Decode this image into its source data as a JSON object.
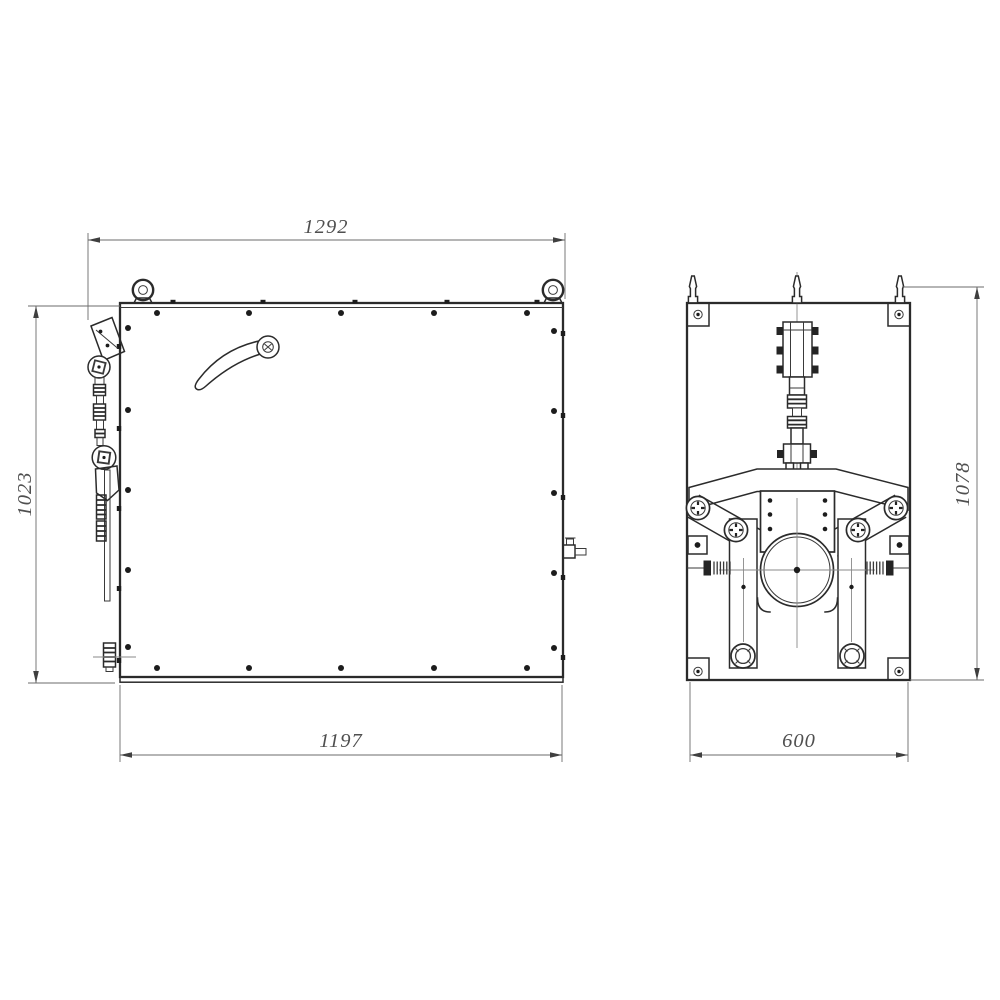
{
  "drawing": {
    "type": "orthographic technical drawing, two views of a machine housing",
    "front_view": {
      "name": "front view",
      "dim_top": "1292",
      "dim_left": "1023",
      "dim_bottom": "1197"
    },
    "side_view": {
      "name": "side view",
      "dim_right": "1078",
      "dim_bottom": "600"
    },
    "colors": {
      "background": "#ffffff",
      "outline": "#2b2b2b",
      "dimension_lines": "#6b6b6b",
      "dimension_text": "#4f4f4f"
    }
  }
}
